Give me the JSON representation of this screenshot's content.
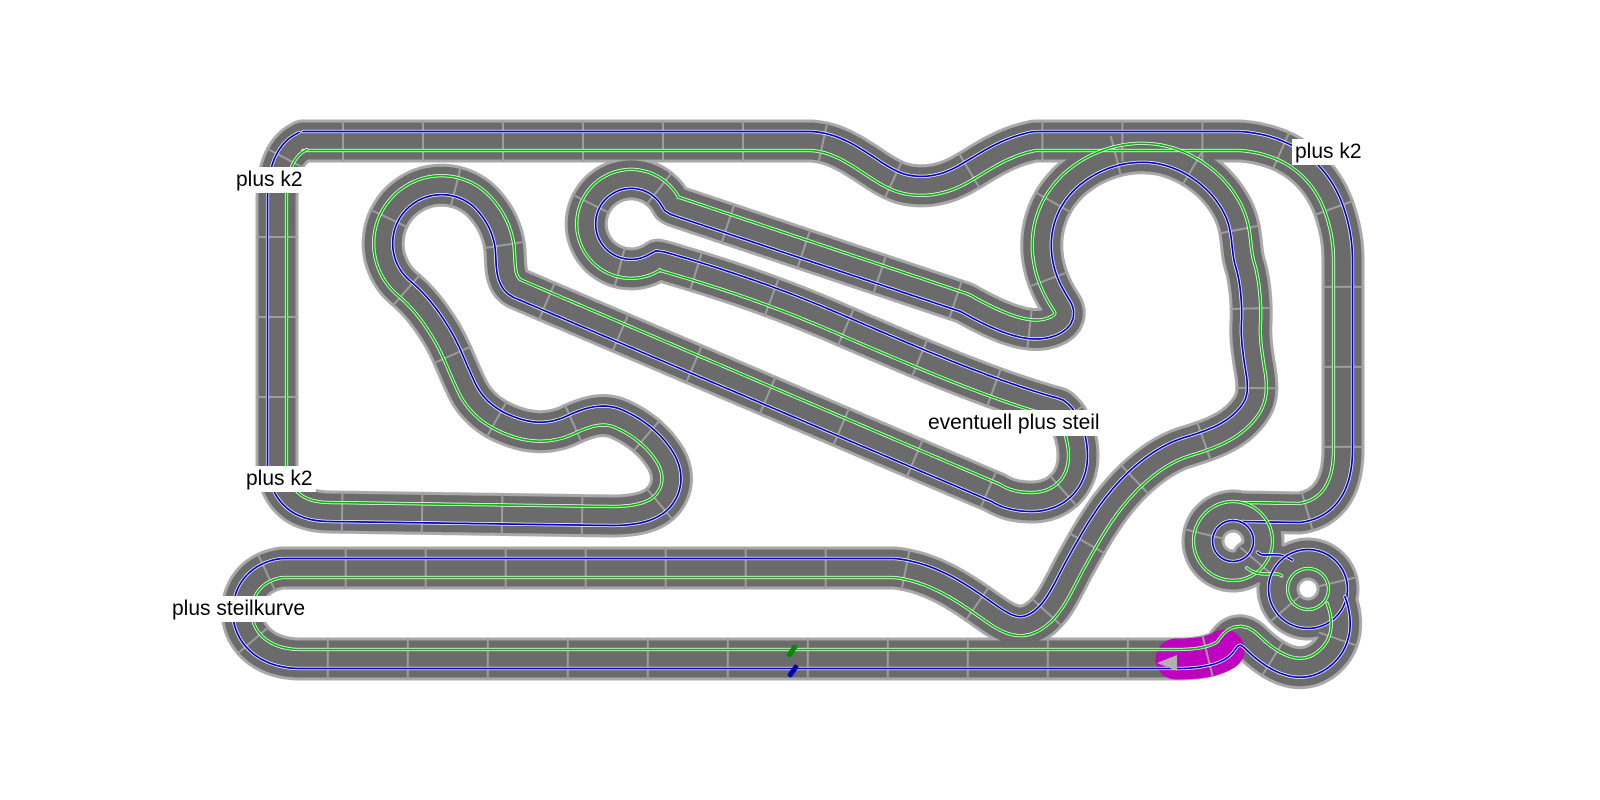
{
  "canvas": {
    "width": 1600,
    "height": 800,
    "background": "#ffffff"
  },
  "palette": {
    "track_border": "#a9a9a9",
    "track_surface": "#6b6b6b",
    "joint_line": "#9d9d9d",
    "lane_blue": "#0000cc",
    "lane_green": "#00b800",
    "lane_rail_white": "#ffffff",
    "selected_piece": "#bf00bf",
    "direction_arrow": "#b0b0b0",
    "label_text": "#000000",
    "label_background": "#ffffff"
  },
  "labels": [
    {
      "id": "top-left",
      "text": "plus k2"
    },
    {
      "id": "top-right",
      "text": "plus k2"
    },
    {
      "id": "middle-left",
      "text": "plus k2"
    },
    {
      "id": "middle-right",
      "text": "eventuell plus steil"
    },
    {
      "id": "bottom-left",
      "text": "plus steilkurve"
    }
  ],
  "markers": {
    "cars": [
      {
        "lane": "green",
        "color": "#008800"
      },
      {
        "lane": "blue",
        "color": "#0000b4"
      }
    ],
    "direction_arrow": {
      "direction": "left",
      "color": "#b0b0b0"
    },
    "selected_piece_location": "bottom straight, before bottom-right pretzel"
  }
}
